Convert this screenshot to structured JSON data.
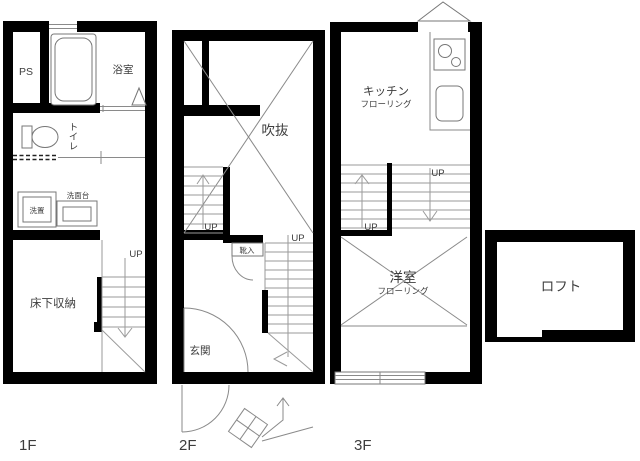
{
  "colors": {
    "wall": "#000000",
    "line": "#8a8a8a",
    "text": "#3d3d3d",
    "background": "#ffffff"
  },
  "floors": {
    "f1": {
      "name": "1F",
      "labels": {
        "ps": "PS",
        "bath": "浴室",
        "toilet": "トイレ",
        "washer": "洗置",
        "vanity": "洗面台",
        "underfloor_storage": "床下収納",
        "up": "UP"
      }
    },
    "f2": {
      "name": "2F",
      "labels": {
        "void": "吹抜",
        "shoe_box": "靴入",
        "entrance": "玄関",
        "up_left": "UP",
        "up_right": "UP"
      }
    },
    "f3": {
      "name": "3F",
      "labels": {
        "kitchen": "キッチン",
        "kitchen_flooring": "フローリング",
        "western_room": "洋室",
        "western_flooring": "フローリング",
        "up_left": "UP",
        "up_right": "UP"
      }
    },
    "loft": {
      "name": "ロフト"
    }
  }
}
